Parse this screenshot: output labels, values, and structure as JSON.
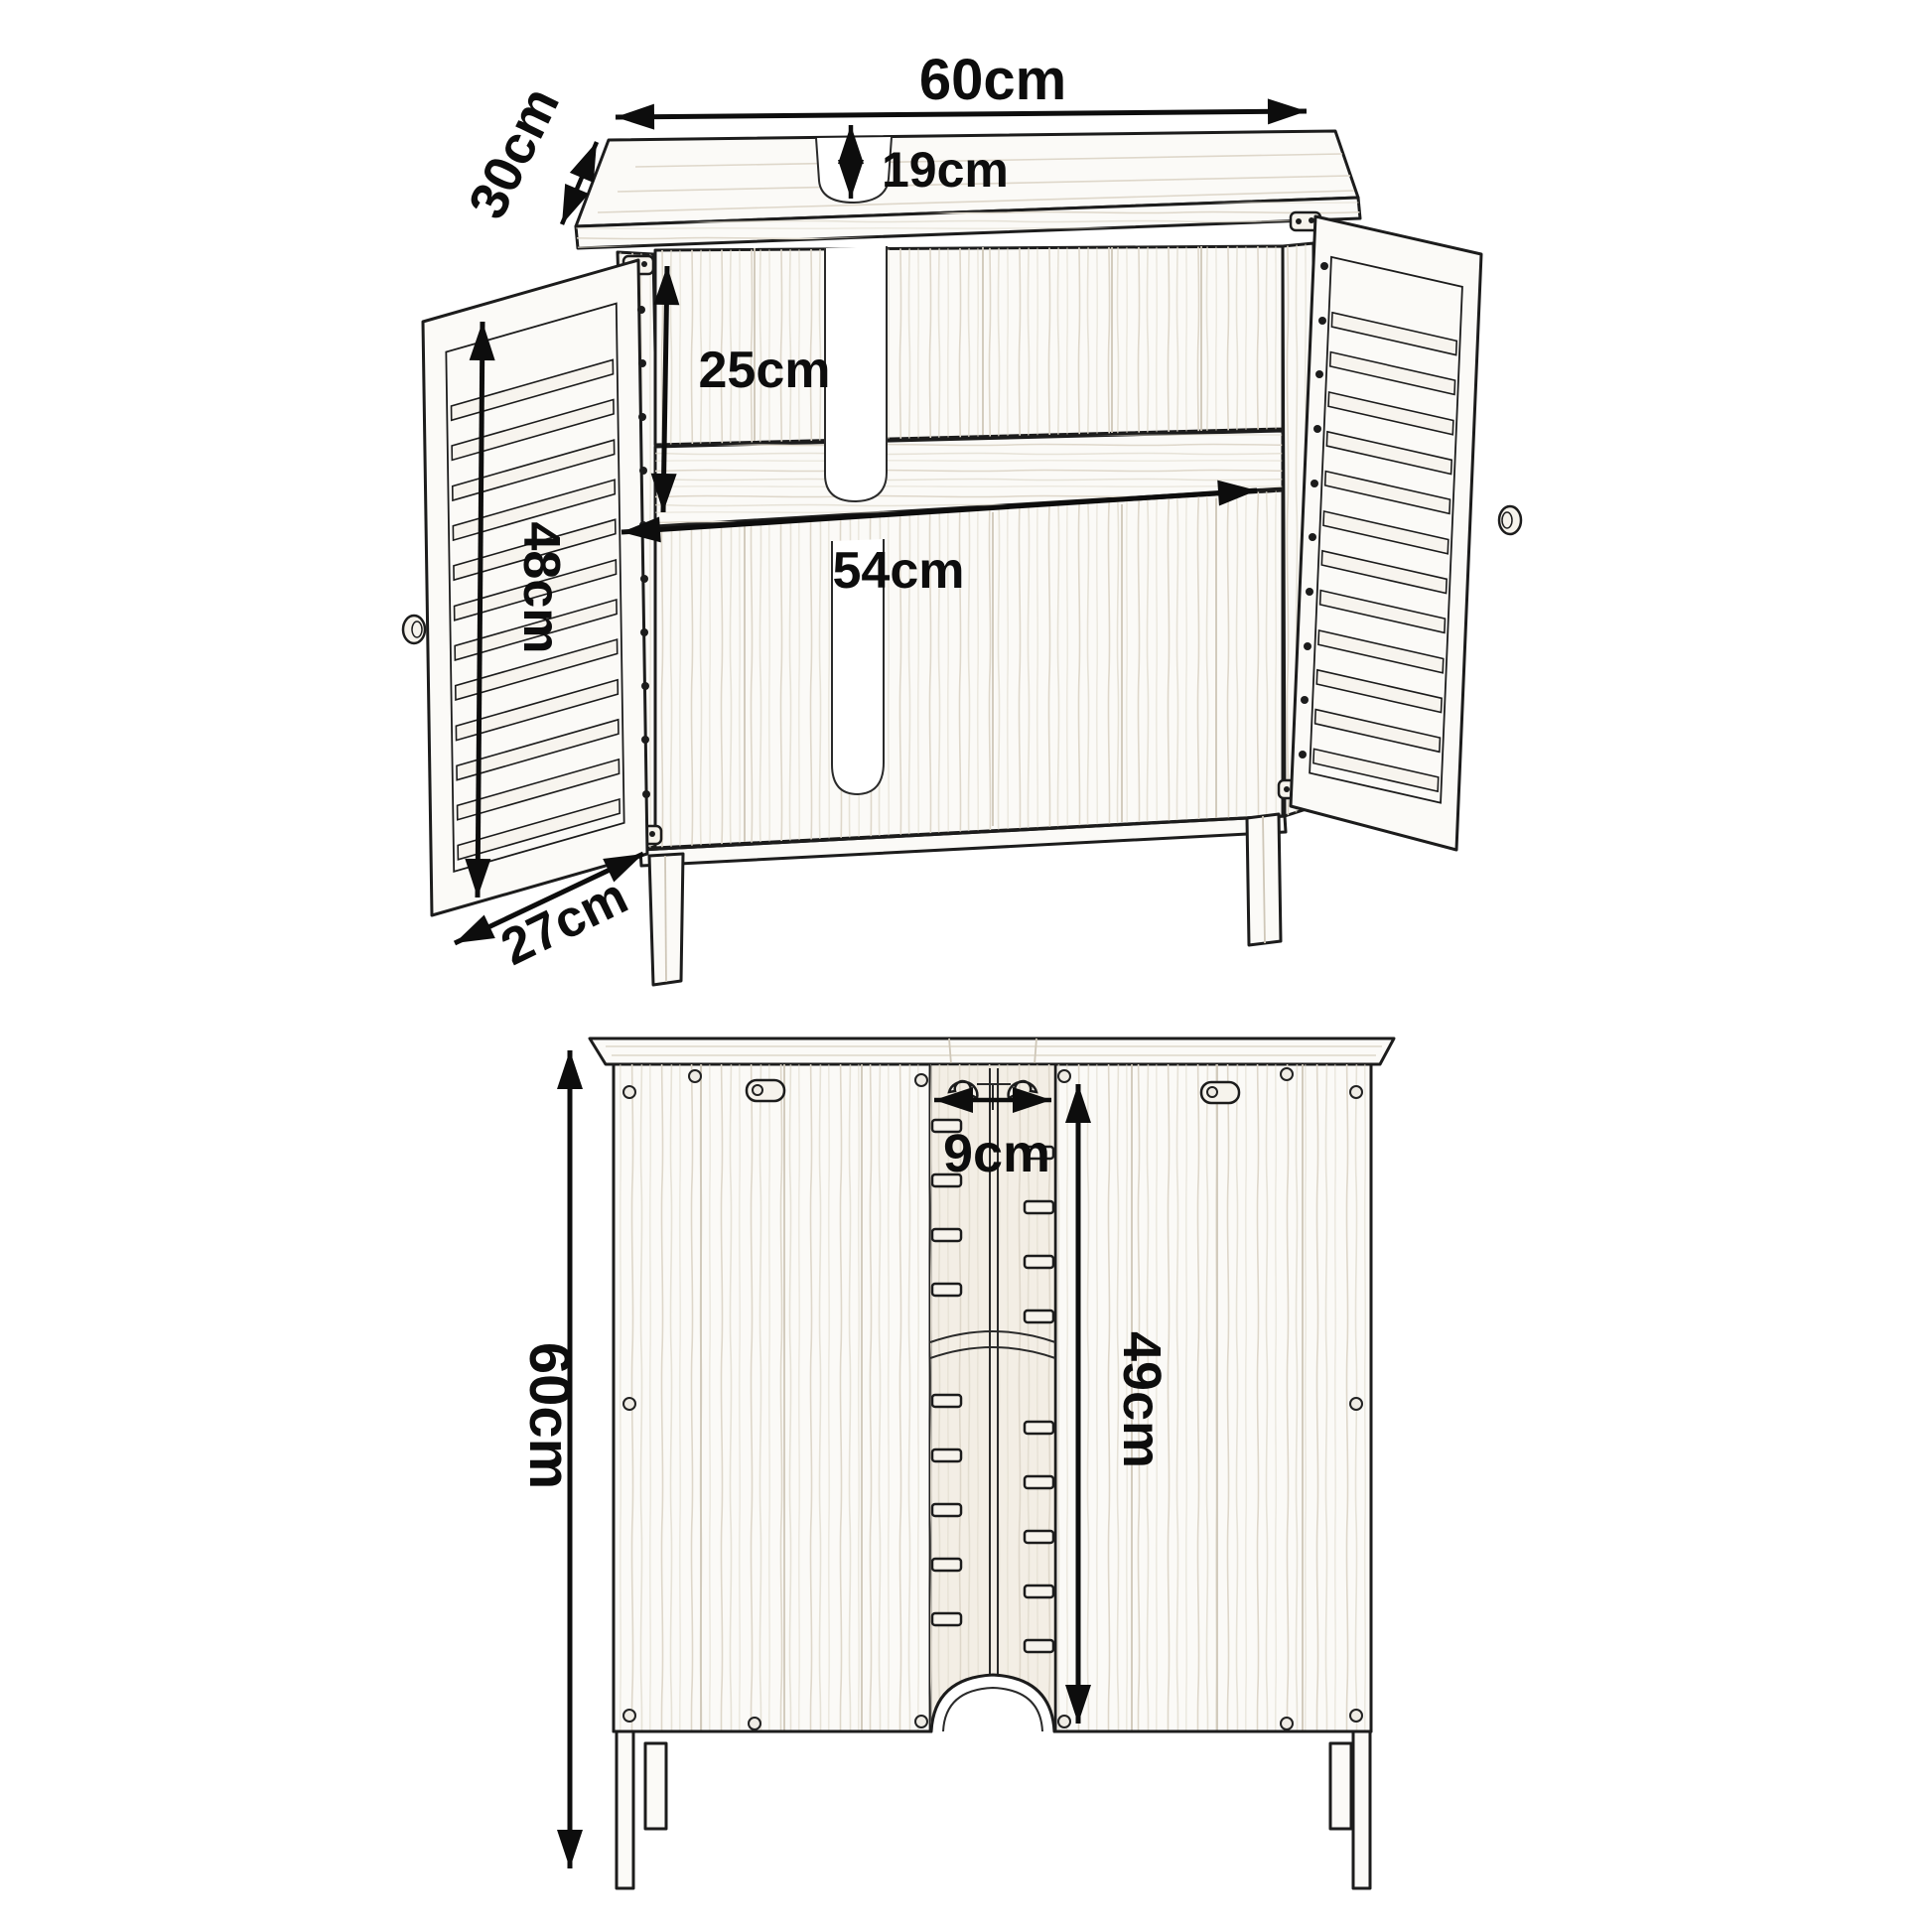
{
  "meta": {
    "background": "#ffffff",
    "ink_color": "#1c1c1c",
    "dimension_color": "#0d0d0d"
  },
  "diagram": {
    "subject": "Under-sink bathroom cabinet with two louvered doors - dimension drawing",
    "front_view": {
      "name": "front perspective view, doors open",
      "top_width": "60cm",
      "top_depth": "30cm",
      "sink_cutout_depth": "19cm",
      "upper_compartment_height": "25cm",
      "interior_width": "54cm",
      "door_height": "48cm",
      "door_depth": "27cm"
    },
    "back_view": {
      "name": "back view",
      "overall_height": "60cm",
      "pipe_channel_width": "9cm",
      "pipe_slot_height": "49cm"
    }
  }
}
